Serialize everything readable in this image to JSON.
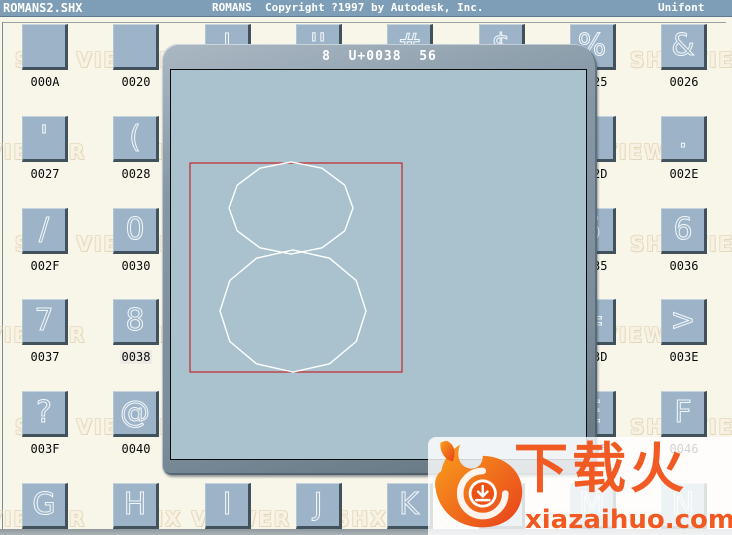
{
  "window": {
    "titlebar": {
      "left": "ROMANS2.SHX",
      "center": "ROMANS  Copyright ?1997 by Autodesk, Inc.",
      "right": "Unifont"
    }
  },
  "watermark": {
    "text": "SHX VIEWER"
  },
  "grid": {
    "selected_code": "0038",
    "cells": [
      {
        "code": "000A",
        "glyph": "",
        "row": 1,
        "col": 1
      },
      {
        "code": "0020",
        "glyph": "",
        "row": 1,
        "col": 2
      },
      {
        "code": "0021",
        "glyph": "!",
        "row": 1,
        "col": 3
      },
      {
        "code": "0022",
        "glyph": "''",
        "row": 1,
        "col": 4
      },
      {
        "code": "0023",
        "glyph": "#",
        "row": 1,
        "col": 5
      },
      {
        "code": "0024",
        "glyph": "$",
        "row": 1,
        "col": 6
      },
      {
        "code": "0025",
        "glyph": "%",
        "row": 1,
        "col": 7
      },
      {
        "code": "0026",
        "glyph": "&",
        "row": 1,
        "col": 8
      },
      {
        "code": "0027",
        "glyph": "'",
        "row": 2,
        "col": 1
      },
      {
        "code": "0028",
        "glyph": "(",
        "row": 2,
        "col": 2
      },
      {
        "code": "002D",
        "glyph": "-",
        "row": 2,
        "col": 7
      },
      {
        "code": "002E",
        "glyph": ".",
        "row": 2,
        "col": 8
      },
      {
        "code": "002F",
        "glyph": "/",
        "row": 3,
        "col": 1
      },
      {
        "code": "0030",
        "glyph": "0",
        "row": 3,
        "col": 2
      },
      {
        "code": "0035",
        "glyph": "5",
        "row": 3,
        "col": 7
      },
      {
        "code": "0036",
        "glyph": "6",
        "row": 3,
        "col": 8
      },
      {
        "code": "0037",
        "glyph": "7",
        "row": 4,
        "col": 1
      },
      {
        "code": "0038",
        "glyph": "8",
        "row": 4,
        "col": 2,
        "selected": true
      },
      {
        "code": "003D",
        "glyph": "=",
        "row": 4,
        "col": 7
      },
      {
        "code": "003E",
        "glyph": ">",
        "row": 4,
        "col": 8
      },
      {
        "code": "003F",
        "glyph": "?",
        "row": 5,
        "col": 1
      },
      {
        "code": "0040",
        "glyph": "@",
        "row": 5,
        "col": 2
      },
      {
        "code": "0045",
        "glyph": "E",
        "row": 5,
        "col": 7
      },
      {
        "code": "0046",
        "glyph": "F",
        "row": 5,
        "col": 8
      },
      {
        "code": "0047",
        "glyph": "G",
        "row": 6,
        "col": 1
      },
      {
        "code": "0048",
        "glyph": "H",
        "row": 6,
        "col": 2
      },
      {
        "code": "0049",
        "glyph": "I",
        "row": 6,
        "col": 3
      },
      {
        "code": "004A",
        "glyph": "J",
        "row": 6,
        "col": 4
      },
      {
        "code": "004B",
        "glyph": "K",
        "row": 6,
        "col": 5
      },
      {
        "code": "004C",
        "glyph": "L",
        "row": 6,
        "col": 6
      },
      {
        "code": "004D",
        "glyph": "M",
        "row": 6,
        "col": 7
      },
      {
        "code": "004E",
        "glyph": "N",
        "row": 6,
        "col": 8
      }
    ]
  },
  "popup": {
    "title": "8  U+0038  56",
    "char": "8",
    "unicode": "U+0038",
    "decimal": "56",
    "drawing": {
      "canvas": {
        "w": 415,
        "h": 389,
        "background": "#a9c2ce"
      },
      "bounds_box": {
        "x": 19,
        "y": 93,
        "w": 212,
        "h": 209,
        "color": "#c4252b"
      },
      "stroke_color": "#ffffff",
      "polylines": [
        [
          [
            182,
            138
          ],
          [
            173.7,
            161
          ],
          [
            151,
            177.8
          ],
          [
            120,
            184
          ],
          [
            89,
            177.8
          ],
          [
            66.3,
            161
          ],
          [
            58,
            138
          ],
          [
            66.3,
            115
          ],
          [
            89,
            98.2
          ],
          [
            120,
            92
          ],
          [
            151,
            98.2
          ],
          [
            173.7,
            115
          ]
        ],
        [
          [
            195,
            241
          ],
          [
            185.2,
            271.5
          ],
          [
            158.5,
            293.8
          ],
          [
            122,
            302
          ],
          [
            85.5,
            293.8
          ],
          [
            58.8,
            271.5
          ],
          [
            49,
            241
          ],
          [
            58.8,
            210.5
          ],
          [
            85.5,
            188.2
          ],
          [
            122,
            180
          ],
          [
            158.5,
            188.2
          ],
          [
            185.2,
            210.5
          ]
        ]
      ]
    }
  },
  "branding": {
    "site_name": "下载火",
    "domain": "xiazaihuo.com",
    "colors": {
      "flame_top": "#f9a11b",
      "flame_bottom": "#e8401c",
      "text": "#f15a22"
    }
  },
  "colors": {
    "topbar": "#7e9db6",
    "background": "#f8f5e9",
    "cell_face": "#9db4c8",
    "cell_shadow": "#42525c",
    "popup_client": "#a9c2ce",
    "glyph_bounds_red": "#c4252b",
    "watermark_text": "#e6dabb"
  }
}
